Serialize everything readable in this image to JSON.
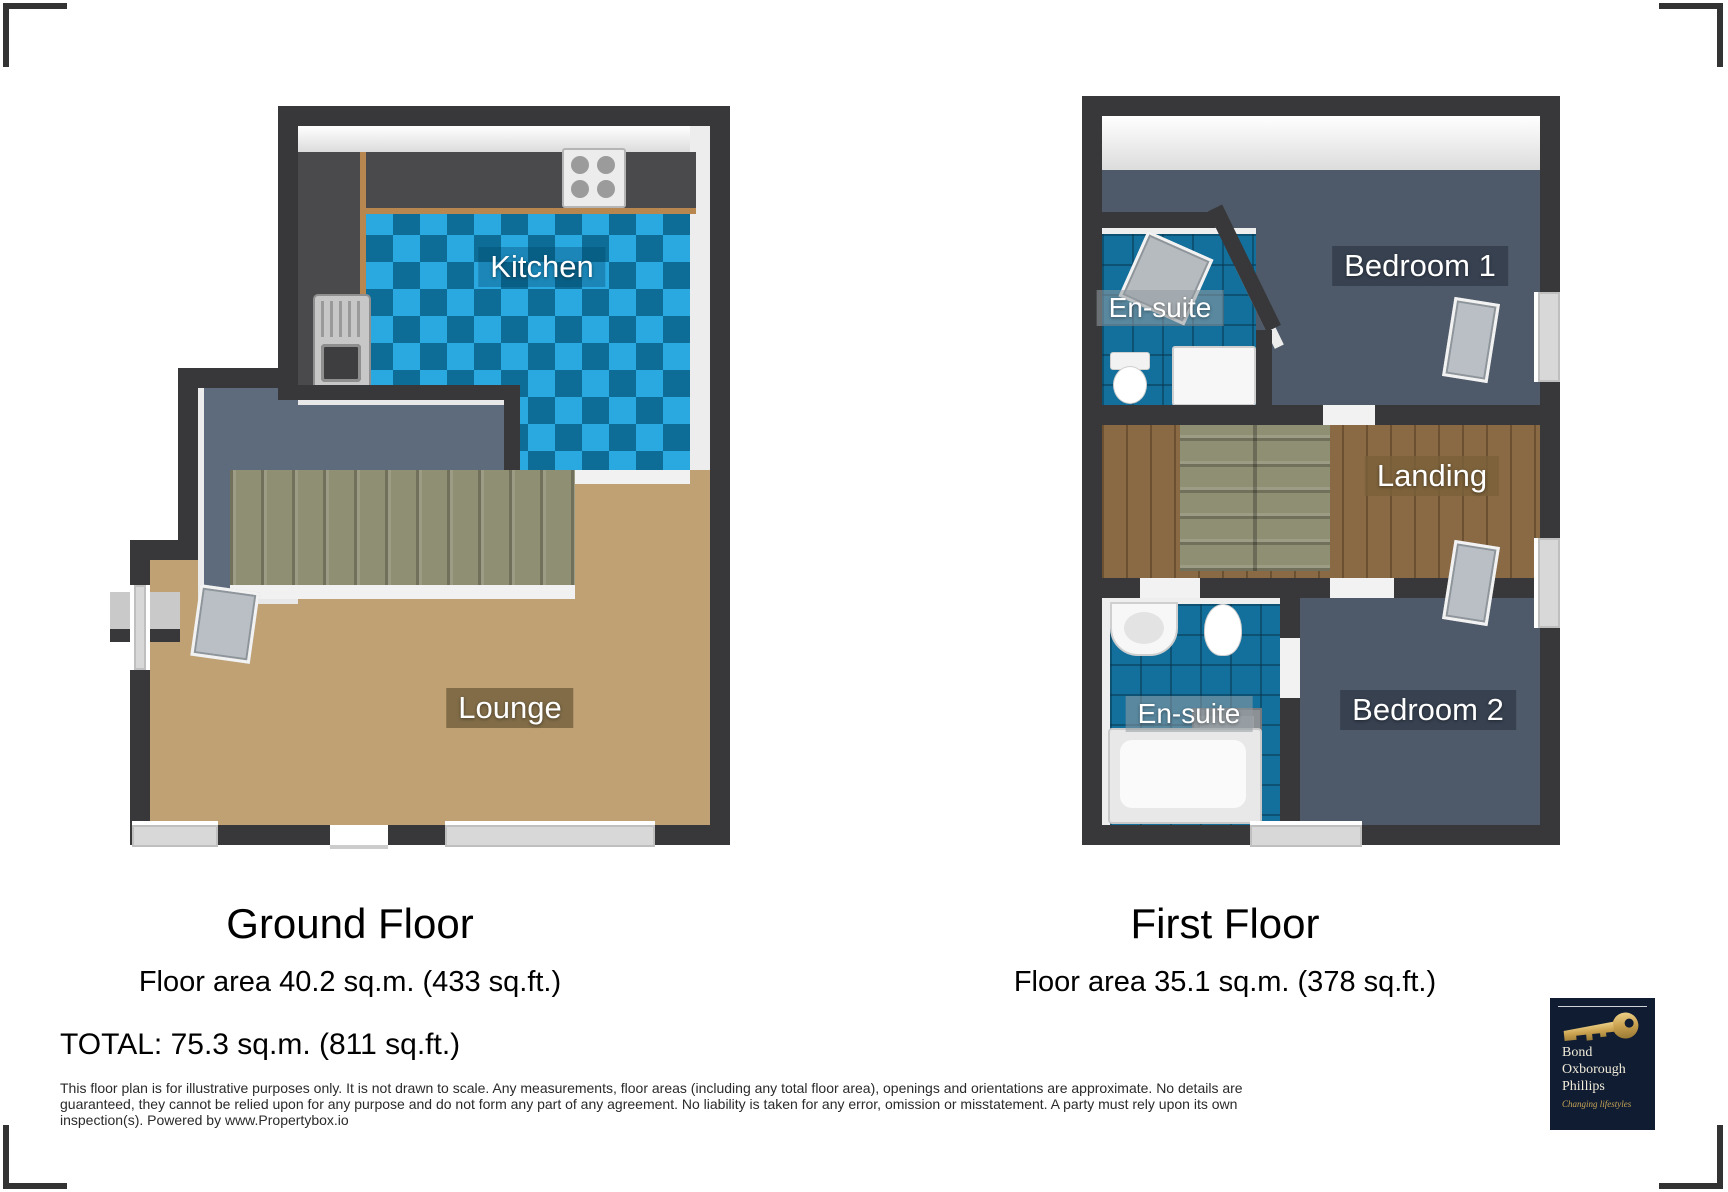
{
  "ground_floor": {
    "title": "Ground Floor",
    "area": "Floor area 40.2 sq.m. (433 sq.ft.)",
    "labels": {
      "kitchen": "Kitchen",
      "lounge": "Lounge"
    }
  },
  "first_floor": {
    "title": "First Floor",
    "area": "Floor area 35.1 sq.m. (378 sq.ft.)",
    "labels": {
      "bedroom1": "Bedroom 1",
      "ensuite1": "En-suite",
      "landing": "Landing",
      "ensuite2": "En-suite",
      "bedroom2": "Bedroom 2"
    }
  },
  "total": "TOTAL: 75.3 sq.m. (811 sq.ft.)",
  "disclaimer": {
    "line1": "This floor plan is for illustrative purposes only. It is not drawn to scale. Any measurements, floor areas (including any total floor area), openings and orientations are approximate. No details are",
    "line2": "guaranteed, they cannot be relied upon for any purpose and do not form any part of any agreement. No liability is taken for any error, omission or misstatement. A party must rely upon its own",
    "line3": "inspection(s). Powered by www.Propertybox.io"
  },
  "logo": {
    "name_line1": "Bond",
    "name_line2": "Oxborough",
    "name_line3": "Phillips",
    "tagline": "Changing lifestyles"
  },
  "colors": {
    "wall": "#38383a",
    "kitchen_tile_light": "#2aa9e0",
    "kitchen_tile_dark": "#0d6d96",
    "bath_tile": "#136f9b",
    "carpet_slate": "#4e5a69",
    "hall_slate": "#5d6b7c",
    "lounge_floor": "#bfa173",
    "landing_wood": "#8a6a45",
    "stairs": "#8f8f74",
    "counter": "#4a4a4c",
    "wood_edge": "#b8864f",
    "logo_bg": "#0f1c31",
    "logo_gold": "#c8a557"
  }
}
